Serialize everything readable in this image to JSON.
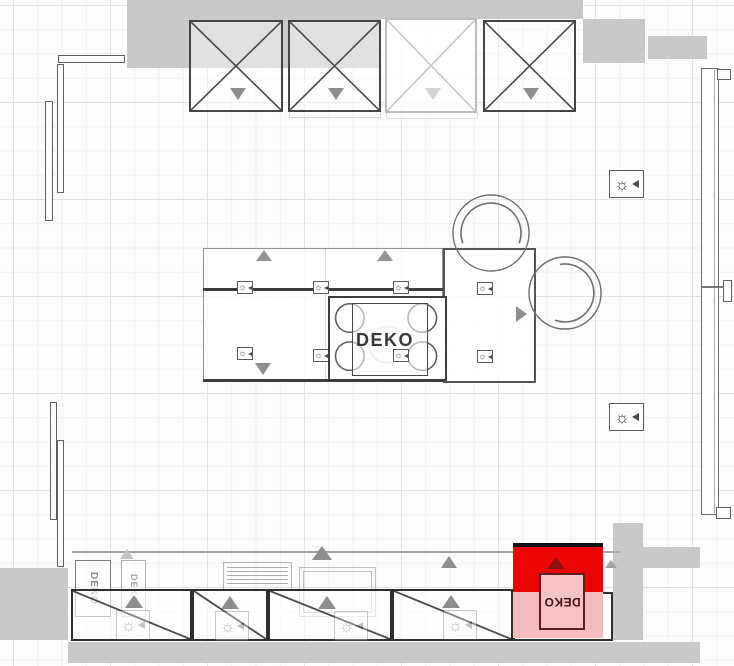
{
  "app": {
    "view": "kitchen-floorplan-top-view"
  },
  "labels": {
    "island_deko": "DEKO",
    "selected_deko": "DEKO",
    "ghost_deko_left": "DEKO",
    "ghost_deko_right": "DEKO"
  },
  "icons": {
    "ceiling_light_glyph": "☼"
  },
  "colors": {
    "selection_red": "#ea0404",
    "selection_pink": "#f5bcbf",
    "selection_box_border": "#5a2020",
    "outside_gray": "#c9c9c9",
    "cabinet_outline": "#454545",
    "symbol_gray": "#8d8d8d"
  },
  "objects": {
    "wall_cabinets": 4,
    "base_cabinets": 4,
    "island_light_symbols": 8,
    "wall_light_symbols": 2,
    "stools": 2
  }
}
